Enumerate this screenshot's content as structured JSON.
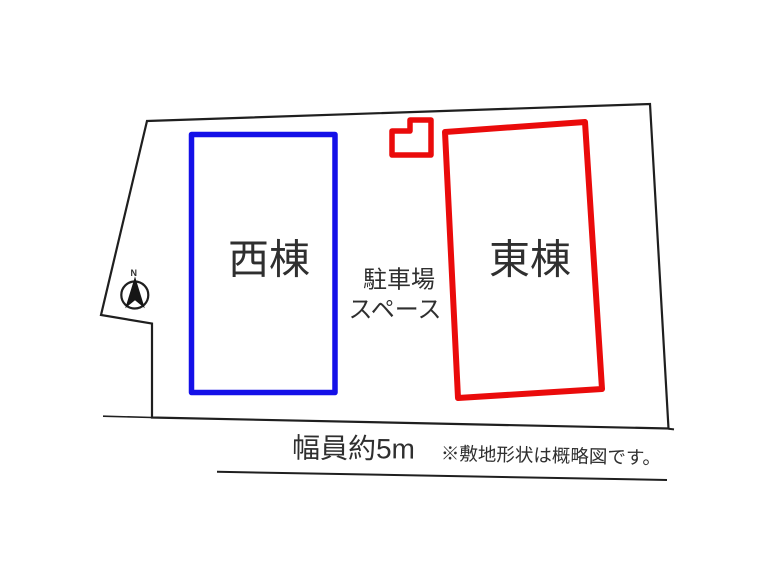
{
  "plan": {
    "west_building": "西棟",
    "east_building": "東棟",
    "parking_line1": "駐車場",
    "parking_line2": "スペース",
    "road_width": "幅員約5m",
    "disclaimer": "※敷地形状は概略図です。",
    "compass_north": "N"
  },
  "colors": {
    "west_building_outline": "#1410e8",
    "east_building_outline": "#ea0b0b",
    "boundary_line": "#1f1f1f",
    "text": "#2f2f2f"
  }
}
